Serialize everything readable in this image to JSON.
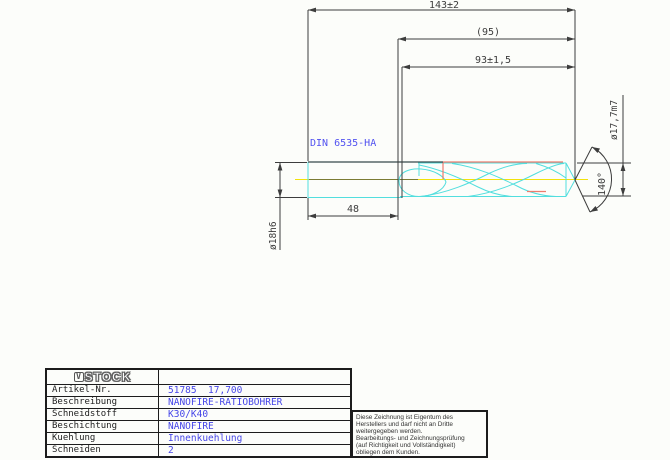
{
  "drawing": {
    "dim_overall": "143±2",
    "dim_ref": "(95)",
    "dim_flute": "93±1,5",
    "dim_shank_len": "48",
    "dim_shank_dia": "ø18h6",
    "dim_cut_dia": "ø17,7m7",
    "dim_point_angle": "140°",
    "shank_standard": "DIN 6535-HA",
    "colors": {
      "outline_cyan": "#52dede",
      "highlight_red": "#ee7b6e",
      "centerline_yellow": "#f2e20a",
      "label_blue": "#5252f0",
      "dimension_gray": "#3d3d3d"
    }
  },
  "title_block": {
    "logo_mark": "V",
    "logo_text": "STOCK",
    "rows": [
      {
        "label": "Artikel-Nr.",
        "value": "51785  17,700"
      },
      {
        "label": "Beschreibung",
        "value": "NANOFIRE-RATIOBOHRER"
      },
      {
        "label": "Schneidstoff",
        "value": "K30/K40"
      },
      {
        "label": "Beschichtung",
        "value": "NANOFIRE"
      },
      {
        "label": "Kuehlung",
        "value": "Innenkuehlung"
      },
      {
        "label": "Schneiden",
        "value": "2"
      }
    ]
  },
  "note": {
    "lines": [
      "Diese Zeichnung ist Eigentum des",
      "Herstellers und darf nicht an Dritte",
      "weitergegeben werden.",
      "Bearbeitungs- und Zeichnungsprüfung",
      "(auf Richtigkeit und Vollständigkeit)",
      "obliegen dem Kunden."
    ]
  }
}
